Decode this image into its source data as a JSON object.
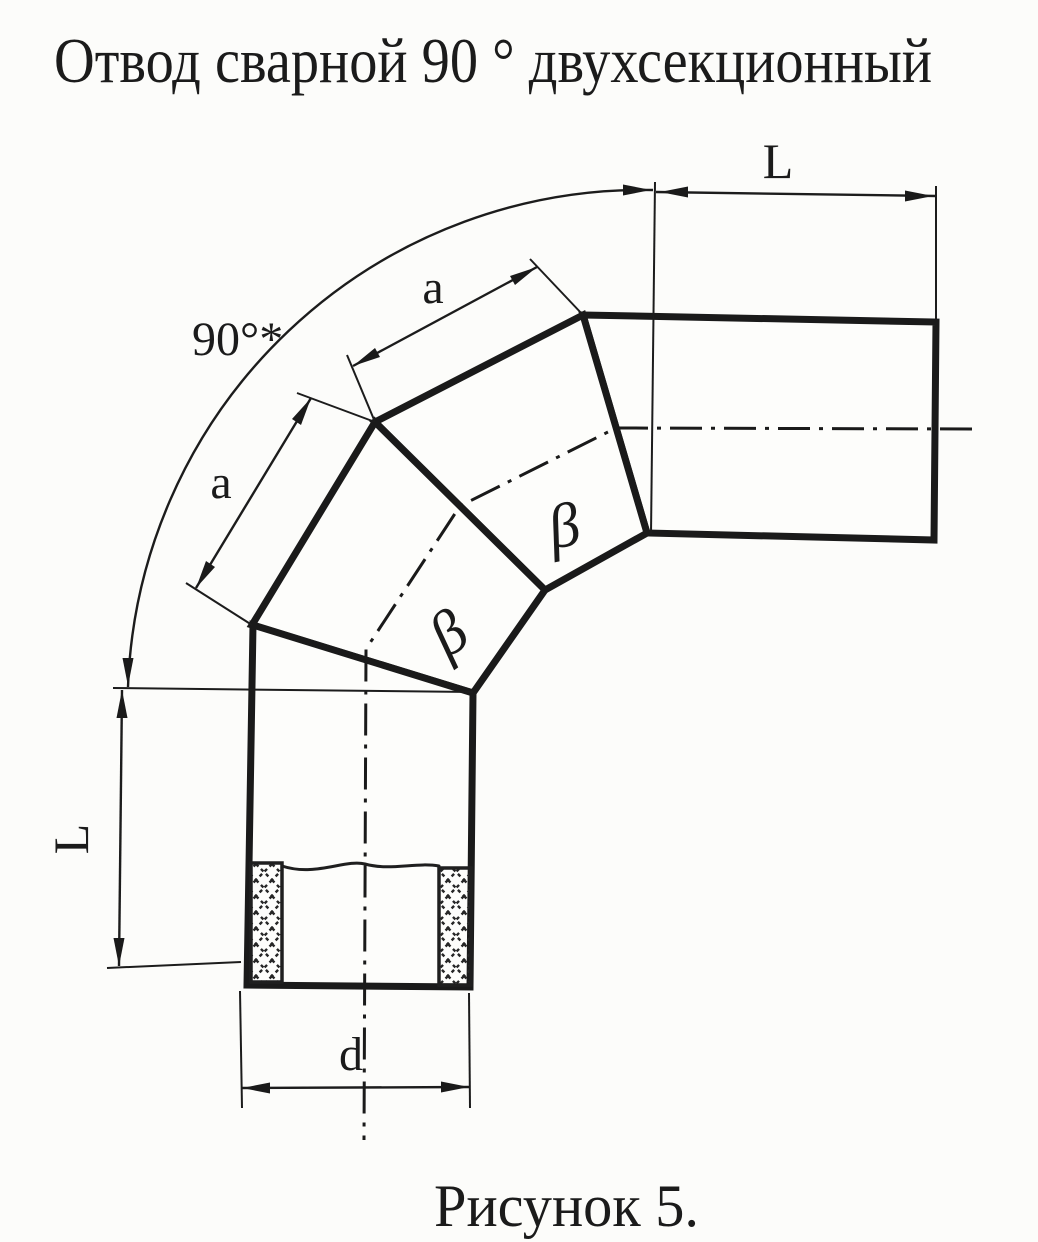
{
  "title": "Отвод сварной 90 ° двухсекционный",
  "caption": "Рисунок 5.",
  "colors": {
    "ink": "#1b1b1b",
    "paper": "#fcfcfa"
  },
  "dimensions": {
    "straight_length_top": "L",
    "straight_length_left": "L",
    "section_width_upper": "a",
    "section_width_lower": "a",
    "bend_angle": "90°*",
    "diameter": "d",
    "bevel_angle_upper": "β",
    "bevel_angle_lower": "β"
  }
}
